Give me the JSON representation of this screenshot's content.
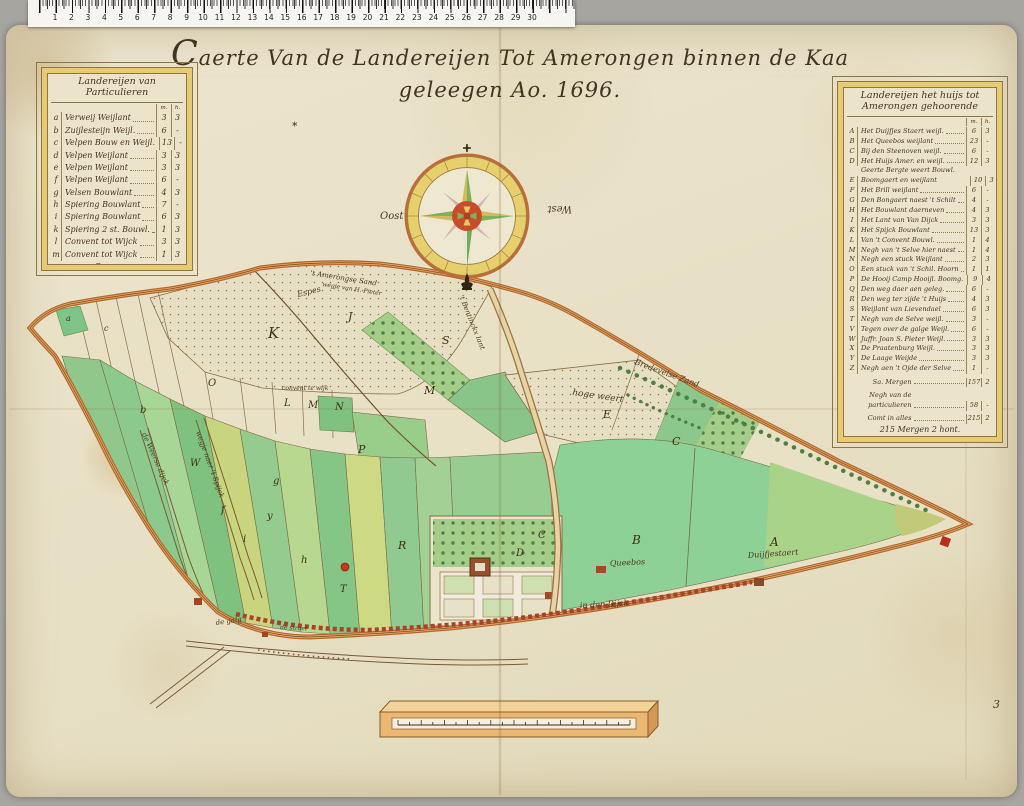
{
  "palette": {
    "paper": "#e8e1c8",
    "table_band": "#e6cb70",
    "boundary_road": "#b4672f",
    "field_green": "#8ed197",
    "compass_red": "#c84c2a"
  },
  "ruler": {
    "numbers": [
      "1",
      "2",
      "3",
      "4",
      "5",
      "6",
      "7",
      "8",
      "9",
      "10",
      "11",
      "12",
      "13",
      "14",
      "15",
      "16",
      "17",
      "18",
      "19",
      "20",
      "21",
      "22",
      "23",
      "24",
      "25",
      "26",
      "27",
      "28",
      "29",
      "30"
    ]
  },
  "title": "Caerte Van de Landereijen Tot Amerongen binnen de Kaa geleegen Ao. 1696.",
  "left_table": {
    "title": "Landereijen van Particulieren",
    "col_headers": [
      "m.",
      "h."
    ],
    "rows": [
      [
        "a",
        "Verweij Weijlant",
        "3",
        "3"
      ],
      [
        "b",
        "Zuijlesteijn Weijl.",
        "6",
        "-"
      ],
      [
        "c",
        "Velpen Bouw en Weijl.",
        "13",
        "-"
      ],
      [
        "d",
        "Velpen Weijlant",
        "3",
        "3"
      ],
      [
        "e",
        "Velpen Weijlant",
        "3",
        "3"
      ],
      [
        "f",
        "Velpen Weijlant",
        "6",
        "-"
      ],
      [
        "g",
        "Velsen Bouwlant",
        "4",
        "3"
      ],
      [
        "h",
        "Spiering Bouwlant",
        "7",
        "-"
      ],
      [
        "i",
        "Spiering Bouwlant",
        "6",
        "3"
      ],
      [
        "k",
        "Spiering 2 st. Bouwl.",
        "1",
        "3"
      ],
      [
        "l",
        "Convent tot Wijck",
        "3",
        "3"
      ],
      [
        "m",
        "Convent tot Wijck",
        "1",
        "3"
      ]
    ],
    "footer": [
      "Sa. Mergen",
      "58",
      "-"
    ]
  },
  "right_table": {
    "title": "Landereijen het huijs tot Amerongen gehoorende",
    "col_headers": [
      "m.",
      "h."
    ],
    "rows": [
      [
        "A",
        "Het Duijfjes Staert weijl.",
        "6",
        "3"
      ],
      [
        "B",
        "Het Queebos weijlant",
        "23",
        "-"
      ],
      [
        "C",
        "Bij den Steenoven weijl.",
        "6",
        "-"
      ],
      [
        "D",
        "Het Huijs Amer. en weijl.",
        "12",
        "3"
      ],
      [
        "E",
        "Geerte Bergte weert Bouwl. Boomgaert en weijlant",
        "10",
        "3"
      ],
      [
        "F",
        "Het Brill weijlant",
        "6",
        "-"
      ],
      [
        "G",
        "Den Bongaert naest 't Schilt",
        "4",
        "-"
      ],
      [
        "H",
        "Het Bouwlant daerneven",
        "4",
        "3"
      ],
      [
        "I",
        "Het Lant van Van Dijck",
        "3",
        "3"
      ],
      [
        "K",
        "Het Spijck Bouwlant",
        "13",
        "3"
      ],
      [
        "L",
        "Van 't Convent Bouwl.",
        "1",
        "4"
      ],
      [
        "M",
        "Negh van 't Selve hier naest",
        "1",
        "4"
      ],
      [
        "N",
        "Negh een stuck Weijlant",
        "2",
        "3"
      ],
      [
        "O",
        "Een stuck van 't Schil. Hoorn",
        "1",
        "1"
      ],
      [
        "P",
        "De Hooij Camp Hooijl. Boomg.",
        "9",
        "4"
      ],
      [
        "Q",
        "Den weg daer aen geleg.",
        "6",
        "-"
      ],
      [
        "R",
        "Den weg ter zijde 't Huijs",
        "4",
        "3"
      ],
      [
        "S",
        "Weijlant van Lievendael",
        "6",
        "3"
      ],
      [
        "T",
        "Negh van de Selve weijl.",
        "3",
        "-"
      ],
      [
        "V",
        "Tegen over de galge Weijl.",
        "6",
        "-"
      ],
      [
        "W",
        "Juffr. Joan S. Pieter Weijl.",
        "3",
        "3"
      ],
      [
        "X",
        "De Praatenburg Weijl.",
        "3",
        "3"
      ],
      [
        "Y",
        "De Laage Weijde",
        "3",
        "3"
      ],
      [
        "Z",
        "Negh aen 't Ojde der Selve",
        "1",
        "-"
      ]
    ],
    "footer_rows": [
      [
        "Sa. Mergen",
        "157",
        "2"
      ],
      [
        "Negh van de particulieren",
        "58",
        "-"
      ],
      [
        "Comt in alles",
        "215",
        "2"
      ]
    ],
    "total_line": "215 Mergen 2 hont."
  },
  "compass": {
    "east_label": "Oost",
    "west_label": "West"
  },
  "map": {
    "margin_mark": "3",
    "labels": [
      {
        "t": "K",
        "x": 268,
        "y": 338,
        "s": 15
      },
      {
        "t": "J",
        "x": 348,
        "y": 320,
        "s": 11
      },
      {
        "t": "S",
        "x": 442,
        "y": 344,
        "s": 11
      },
      {
        "t": "M",
        "x": 424,
        "y": 394,
        "s": 11
      },
      {
        "t": "O",
        "x": 208,
        "y": 386,
        "s": 10
      },
      {
        "t": "L",
        "x": 284,
        "y": 406,
        "s": 10
      },
      {
        "t": "M",
        "x": 308,
        "y": 408,
        "s": 10
      },
      {
        "t": "N",
        "x": 335,
        "y": 410,
        "s": 10
      },
      {
        "t": "E",
        "x": 603,
        "y": 418,
        "s": 11
      },
      {
        "t": "C",
        "x": 672,
        "y": 445,
        "s": 11
      },
      {
        "t": "C",
        "x": 538,
        "y": 538,
        "s": 10
      },
      {
        "t": "B",
        "x": 632,
        "y": 544,
        "s": 12
      },
      {
        "t": "A",
        "x": 770,
        "y": 546,
        "s": 12
      },
      {
        "t": "W",
        "x": 190,
        "y": 466,
        "s": 10
      },
      {
        "t": "b",
        "x": 140,
        "y": 413,
        "s": 10
      },
      {
        "t": "f",
        "x": 221,
        "y": 513,
        "s": 10
      },
      {
        "t": "y",
        "x": 267,
        "y": 519,
        "s": 10
      },
      {
        "t": "g",
        "x": 273,
        "y": 484,
        "s": 10
      },
      {
        "t": "i",
        "x": 243,
        "y": 542,
        "s": 10
      },
      {
        "t": "h",
        "x": 301,
        "y": 563,
        "s": 10
      },
      {
        "t": "P",
        "x": 358,
        "y": 453,
        "s": 11
      },
      {
        "t": "R",
        "x": 398,
        "y": 549,
        "s": 11
      },
      {
        "t": "D",
        "x": 516,
        "y": 556,
        "s": 10
      },
      {
        "t": "T",
        "x": 340,
        "y": 592,
        "s": 10
      },
      {
        "t": "a",
        "x": 66,
        "y": 321,
        "s": 8
      },
      {
        "t": "c",
        "x": 104,
        "y": 331,
        "s": 8
      },
      {
        "t": "*",
        "x": 292,
        "y": 130,
        "s": 11
      }
    ],
    "place_names": [
      {
        "t": "Espes",
        "x": 298,
        "y": 297,
        "r": -14,
        "s": 8
      },
      {
        "t": "'t Amerongse Sand",
        "x": 310,
        "y": 275,
        "r": 9,
        "s": 7
      },
      {
        "t": "wegje van H. Pieter",
        "x": 322,
        "y": 286,
        "r": 9,
        "s": 6
      },
      {
        "t": "'t Bentinckx lant",
        "x": 459,
        "y": 296,
        "r": 68,
        "s": 7
      },
      {
        "t": "Bredevelse Zand",
        "x": 634,
        "y": 364,
        "r": 20,
        "s": 8
      },
      {
        "t": "hoge weert",
        "x": 572,
        "y": 395,
        "r": 8,
        "s": 9
      },
      {
        "t": "convent te wijk",
        "x": 282,
        "y": 390,
        "r": 0,
        "s": 6
      },
      {
        "t": "Queebos",
        "x": 610,
        "y": 566,
        "r": -3,
        "s": 8
      },
      {
        "t": "Duijfjestaert",
        "x": 748,
        "y": 558,
        "r": -4,
        "s": 8
      },
      {
        "t": "in den Dijck",
        "x": 580,
        "y": 608,
        "r": -3,
        "s": 8
      },
      {
        "t": "de galg",
        "x": 216,
        "y": 625,
        "r": -8,
        "s": 7
      },
      {
        "t": "de straet",
        "x": 280,
        "y": 629,
        "r": 3,
        "s": 6
      },
      {
        "t": "de Weerse dijck",
        "x": 142,
        "y": 434,
        "r": 66,
        "s": 7
      },
      {
        "t": "wegje naer 't Spijck",
        "x": 196,
        "y": 432,
        "r": 70,
        "s": 7
      }
    ]
  }
}
